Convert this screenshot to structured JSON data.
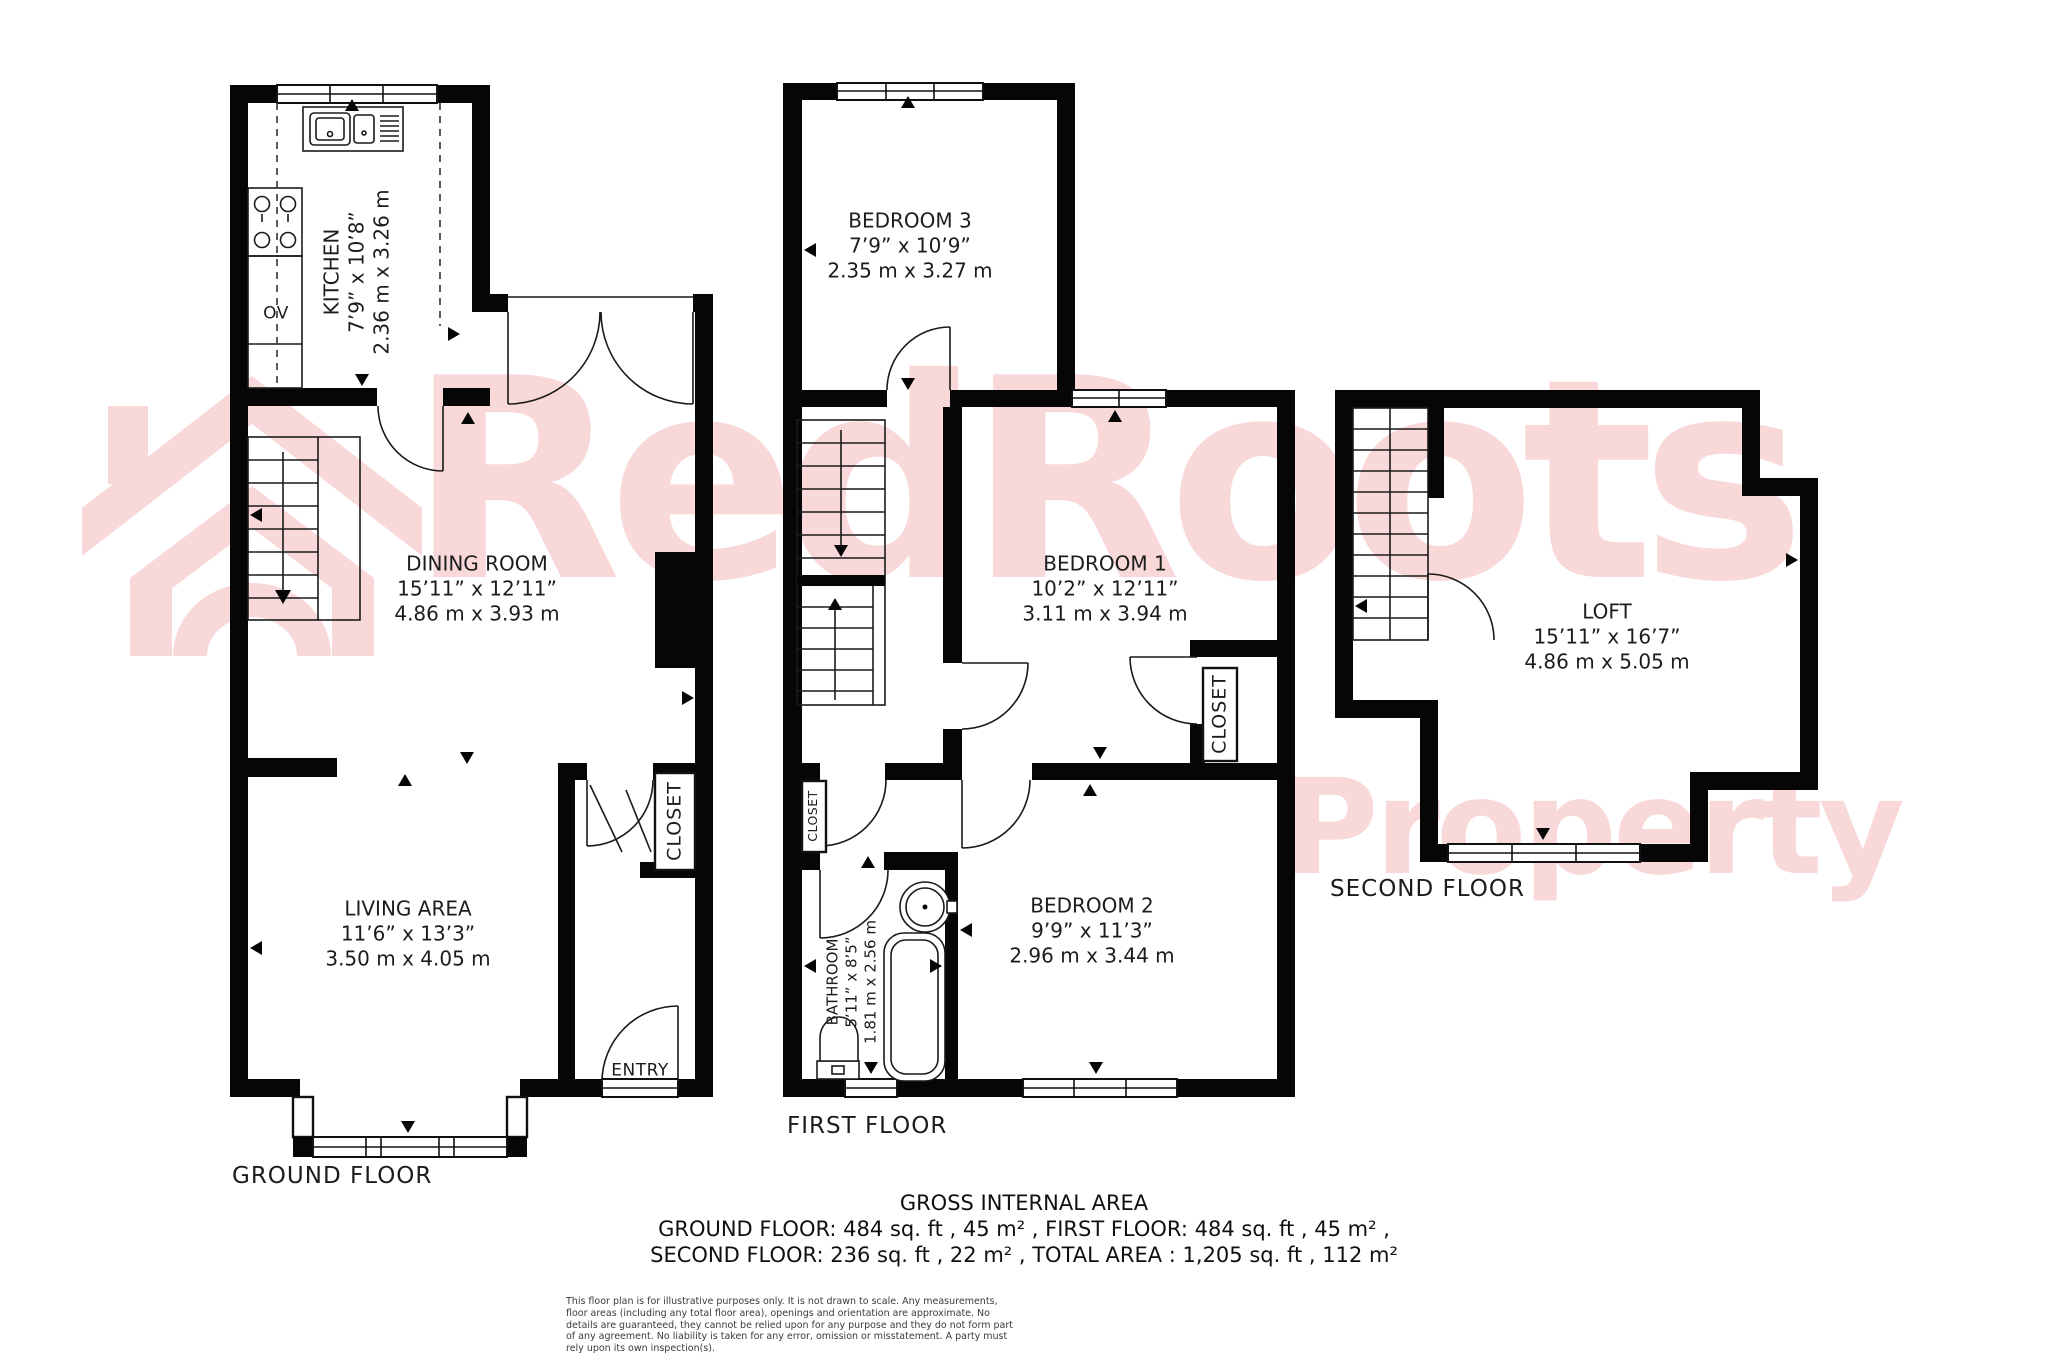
{
  "watermark": {
    "brand": "RedRoots",
    "word2": "Property",
    "color": "#f8d8d9",
    "house_icon": "house-roof-watermark-icon"
  },
  "floors": {
    "ground": {
      "label": "GROUND FLOOR",
      "rooms": {
        "kitchen": {
          "name": "KITCHEN",
          "imperial": "7’9” x 10’8”",
          "metric": "2.36 m x 3.26 m"
        },
        "dining": {
          "name": "DINING ROOM",
          "imperial": "15’11” x 12’11”",
          "metric": "4.86 m x 3.93 m"
        },
        "living": {
          "name": "LIVING AREA",
          "imperial": "11’6” x 13’3”",
          "metric": "3.50 m x 4.05 m"
        },
        "closet": {
          "name": "CLOSET"
        },
        "entry": {
          "name": "ENTRY"
        },
        "oven": {
          "name": "OV"
        }
      }
    },
    "first": {
      "label": "FIRST FLOOR",
      "rooms": {
        "bedroom3": {
          "name": "BEDROOM 3",
          "imperial": "7’9” x 10’9”",
          "metric": "2.35 m x 3.27 m"
        },
        "bedroom1": {
          "name": "BEDROOM 1",
          "imperial": "10’2” x 12’11”",
          "metric": "3.11 m x 3.94 m"
        },
        "bedroom2": {
          "name": "BEDROOM 2",
          "imperial": "9’9” x 11’3”",
          "metric": "2.96 m x 3.44 m"
        },
        "bathroom": {
          "name": "BATHROOM",
          "imperial": "5’11” x 8’5”",
          "metric": "1.81 m x 2.56 m"
        },
        "closet_hall": {
          "name": "CLOSET"
        },
        "closet_bedroom": {
          "name": "CLOSET"
        }
      }
    },
    "second": {
      "label": "SECOND FLOOR",
      "rooms": {
        "loft": {
          "name": "LOFT",
          "imperial": "15’11” x 16’7”",
          "metric": "4.86 m x 5.05 m"
        }
      }
    }
  },
  "summary": {
    "title": "GROSS INTERNAL AREA",
    "line1": "GROUND FLOOR: 484 sq. ft , 45 m² , FIRST FLOOR: 484 sq. ft , 45 m² ,",
    "line2": "SECOND FLOOR: 236 sq. ft , 22 m² , TOTAL AREA : 1,205 sq. ft , 112 m²"
  },
  "disclaimer": "This floor plan is for illustrative purposes only. It is not drawn to scale. Any measurements, floor areas (including any total floor area), openings and orientation are approximate. No details are guaranteed, they cannot be relied upon for any purpose and they do not form part of any agreement. No liability is taken for any error, omission or misstatement. A party must rely upon its own inspection(s)."
}
